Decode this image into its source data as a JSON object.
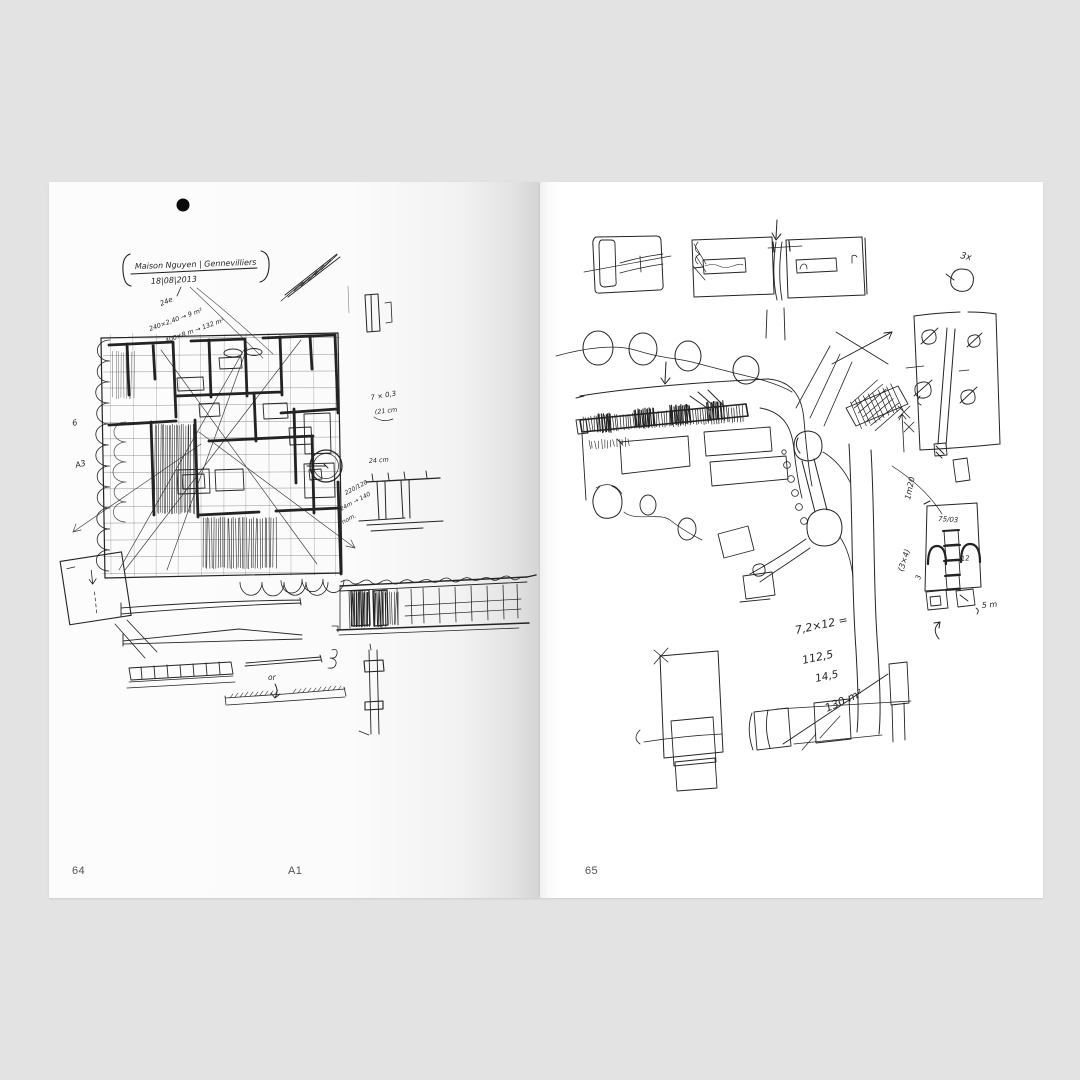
{
  "book": {
    "background_color": "#e3e3e3",
    "page_color": "#ffffff",
    "ink_color": "#232323"
  },
  "left_page": {
    "page_number": "64",
    "plate_label": "A1",
    "header": {
      "title": "Maison Nguyen | Gennevilliers",
      "date": "18|08|2013"
    },
    "notes": {
      "roof_note": "24e",
      "calc_line_1": "240×2,40 → 9 m²",
      "calc_line_2": "400×8 m → 132 m²",
      "dim_7x03": "7 × 0,3",
      "dim_21cm": "(21 cm",
      "dim_24cm": "24 cm",
      "dim_220_120": "220/120",
      "dim_24m_140": "24m → 140",
      "dim_nom": "nom.",
      "margin_6": "6",
      "margin_a3": "A3",
      "or_label": "or"
    }
  },
  "right_page": {
    "page_number": "65",
    "notes": {
      "count_3x": "3x",
      "dim_1m20": "1m20",
      "dim_75_03": "75/03",
      "dim_12": "12",
      "dim_3": "3",
      "dim_5m": "5 m",
      "dim_3x4": "(3×4)",
      "calc_expression": "7,2×12 =",
      "calc_result_1": "112,5",
      "calc_result_2": "14,5",
      "calc_area": "130 m²"
    }
  }
}
